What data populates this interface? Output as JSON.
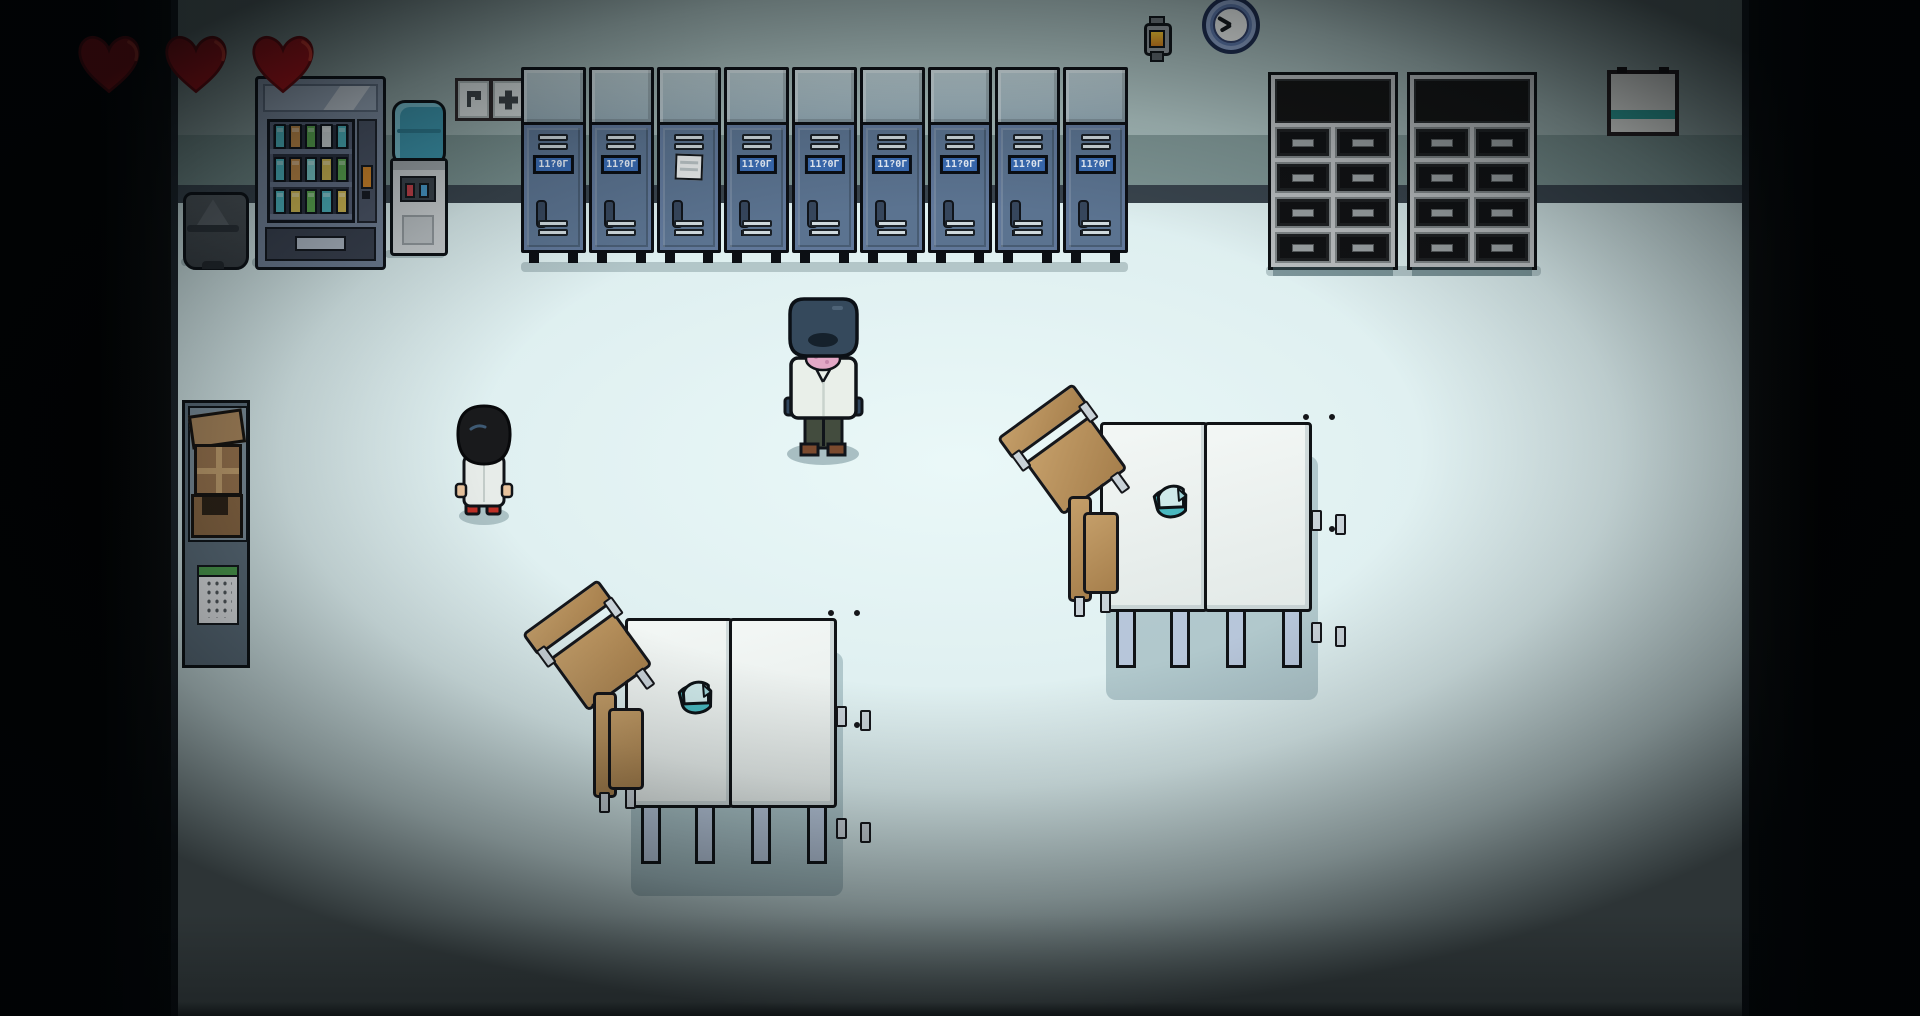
{
  "hud": {
    "hearts_count": 3
  },
  "colors": {
    "heart": "#b01218",
    "heart_highlight": "#e03a2e",
    "wall_upper": "#a6bbba",
    "wall_lower": "#7f9695",
    "baseboard": "#39444d",
    "floor": "#ddeeee",
    "locker_body": "#5d7590",
    "locker_top": "#a7bcc4",
    "plate": "#3a6cb4",
    "plate_text_color": "#eaf2fc",
    "cap": "#49b8bf",
    "cap_light": "#cfe9ea",
    "chair_wood": "#b28b58",
    "table_top": "#eef2f0",
    "can_teal": "#4fb9c4",
    "can_amber": "#c98f4a",
    "can_green": "#5fae53",
    "can_yellow": "#d9c055",
    "can_aqua": "#7fd4d4",
    "can_white": "#dfe6e6",
    "bottle_blue": "#3d96ad",
    "tap_red": "#c04048",
    "tap_blue": "#4898c8",
    "keypad_green": "#4d9e4e",
    "board_stripe": "#2ea19b",
    "lantern_glow": "#f2c330"
  },
  "lockers": {
    "count": 9,
    "plate_text": "11?0Γ",
    "paper_locker_index": 3
  },
  "vending_machine": {
    "shelves": [
      [
        "teal",
        "amber",
        "green",
        "white",
        "teal"
      ],
      [
        "teal",
        "amber",
        "aqua",
        "yellow",
        "green"
      ],
      [
        "teal",
        "yellow",
        "green",
        "teal",
        "yellow"
      ]
    ]
  },
  "cabinets": {
    "units": 2,
    "rows": 4,
    "cols": 2
  },
  "clock": {
    "hand_angles_deg": [
      300,
      240
    ]
  },
  "signs": [
    {
      "icon": "flag-icon"
    },
    {
      "icon": "plus-icon"
    }
  ],
  "tables": {
    "groups": 2,
    "chairs_per_group": 4,
    "item_on_each_table": "teal-cap"
  },
  "characters": [
    {
      "id": "scientist-npc",
      "look": "tall figure, dark hooded head, pink scarf, white lab coat"
    },
    {
      "id": "player",
      "look": "small child, black bob hair, white coat, red shoes"
    }
  ]
}
